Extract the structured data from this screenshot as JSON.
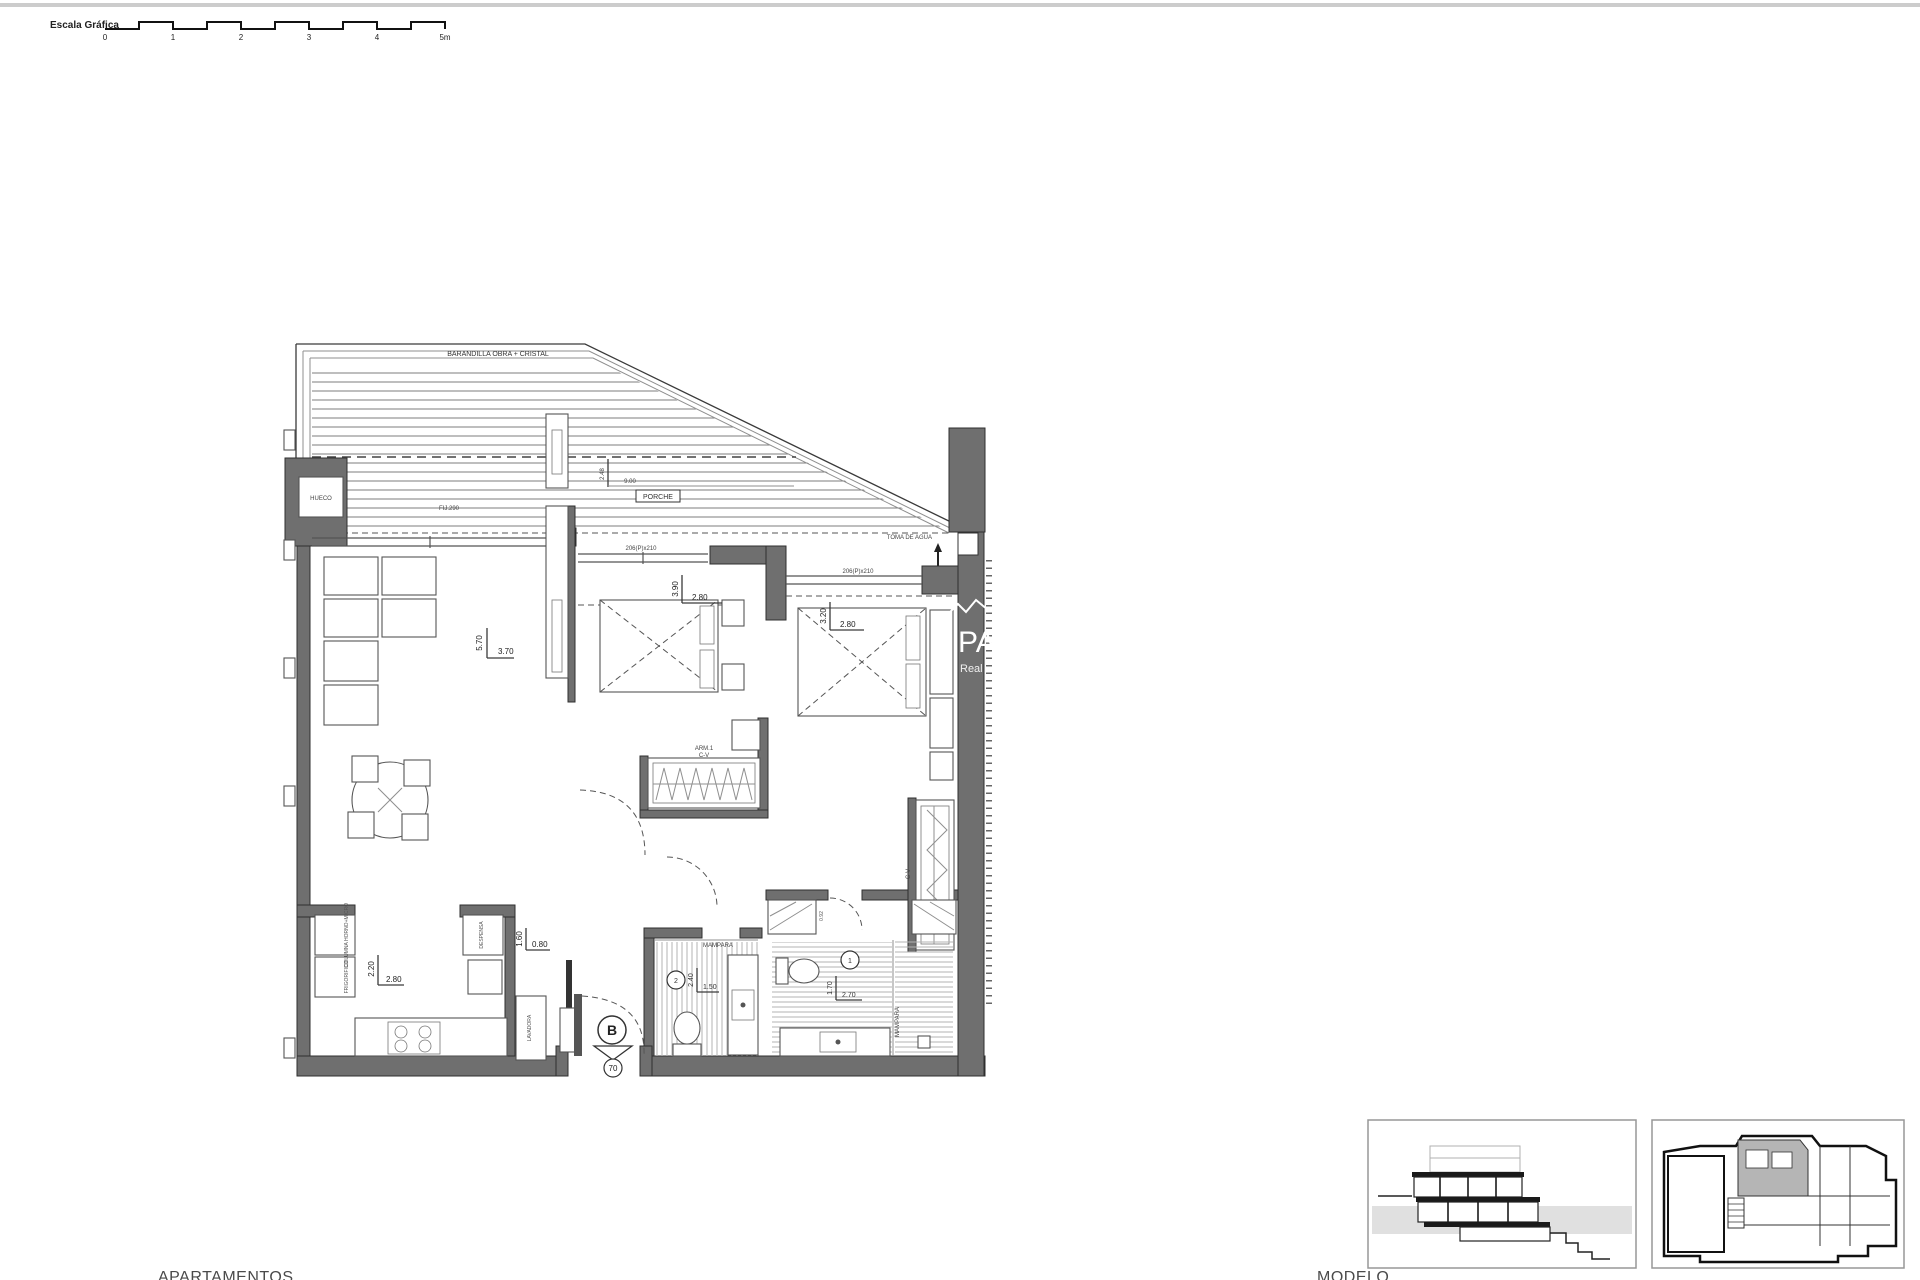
{
  "colors": {
    "wall": "#6f6f6f",
    "line": "#3a3a3a",
    "ground": "#e0e0e0",
    "unit_highlight": "#b5b5b5"
  },
  "scale_bar": {
    "label": "Escala Gráfica",
    "ticks": [
      "0",
      "1",
      "2",
      "3",
      "4",
      "5m"
    ]
  },
  "terrace": {
    "railing_label": "BARANDILLA OBRA + CRISTAL",
    "porch_label": "PORCHE",
    "porch_width": "9.00",
    "porch_height": "2.48",
    "fixed_window": "FIJ.290",
    "hueco": "HUECO",
    "water_tap": "TOMA DE AGUA",
    "slider1": "206(P)x210",
    "slider2": "206(P)x210"
  },
  "living": {
    "dim_v": "5.70",
    "dim_h": "3.70"
  },
  "bedroom1": {
    "dim_v": "3.90",
    "dim_h": "2.80",
    "closet_top": "ARM.1",
    "closet_bottom": "C-V"
  },
  "bedroom2": {
    "dim_v": "3.20",
    "dim_h": "2.80",
    "closet_label": "C-V"
  },
  "kitchen": {
    "dim_v": "2.20",
    "dim_h": "2.80",
    "tall_units": "COLUMNA HORNO+MICRO",
    "fridge": "FRIGORIFICO",
    "pantry": "DESPENSA"
  },
  "hall": {
    "dim_v": "1.60",
    "dim_h": "0.80",
    "laundry": "LAVADORA"
  },
  "bath2": {
    "num": "2",
    "dim_v": "2.40",
    "dim_h": "1.50",
    "screen": "MAMPARA"
  },
  "bath1": {
    "num": "1",
    "dim_v": "1.70",
    "dim_h": "2.70",
    "screen": "MAMPARA",
    "cab_dim": "0.92"
  },
  "entrance": {
    "unit": "B",
    "door": "70"
  },
  "watermark": {
    "big": "PA",
    "small": "Real"
  },
  "footer": {
    "left": "APARTAMENTOS",
    "right": "MODELO"
  }
}
